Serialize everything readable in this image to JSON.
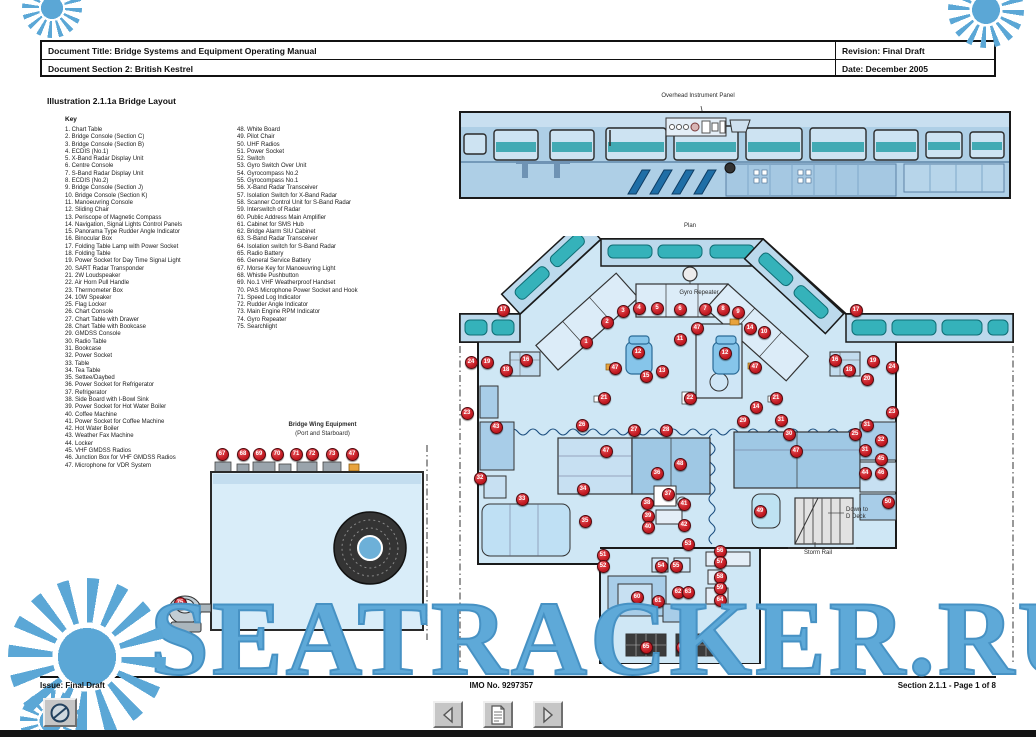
{
  "header": {
    "title": "Document Title: Bridge Systems and Equipment Operating Manual",
    "section": "Document Section 2: British Kestrel",
    "revision": "Revision: Final Draft",
    "date": "Date: December 2005"
  },
  "illustration_title": "Illustration 2.1.1a Bridge Layout",
  "key": {
    "heading": "Key",
    "col1": [
      "1. Chart Table",
      "2. Bridge Console (Section C)",
      "3. Bridge Console (Section B)",
      "4. ECDIS (No.1)",
      "5. X-Band Radar Display Unit",
      "6. Centre Console",
      "7. S-Band Radar Display Unit",
      "8. ECDIS (No.2)",
      "9. Bridge Console (Section J)",
      "10. Bridge Console (Section K)",
      "11. Manoeuvring Console",
      "12. Sliding Chair",
      "13. Periscope of Magnetic Compass",
      "14. Navigation, Signal Lights Control Panels",
      "15. Panorama Type Rudder Angle Indicator",
      "16. Binocular Box",
      "17. Folding Table Lamp with Power Socket",
      "18. Folding Table",
      "19. Power Socket for Day Time Signal Light",
      "20. SART Radar Transponder",
      "21. 2W Loudspeaker",
      "22. Air Horn Pull Handle",
      "23. Thermometer Box",
      "24. 10W Speaker",
      "25. Flag Locker",
      "26. Chart Console",
      "27. Chart Table with Drawer",
      "28. Chart Table with Bookcase",
      "29. GMDSS Console",
      "30. Radio Table",
      "31. Bookcase",
      "32. Power Socket",
      "33. Table",
      "34. Tea Table",
      "35. Settee/Daybed",
      "36. Power Socket for Refrigerator",
      "37. Refrigerator",
      "38. Side Board with I-Bowl Sink",
      "39. Power Socket for Hot Water Boiler",
      "40. Coffee Machine",
      "41. Power Socket for Coffee Machine",
      "42. Hot Water Boiler",
      "43. Weather Fax Machine",
      "44. Locker",
      "45. VHF GMDSS Radios",
      "46. Junction Box for VHF GMDSS Radios",
      "47. Microphone for VDR System"
    ],
    "col2": [
      "48. White Board",
      "49. Pilot Chair",
      "50. UHF Radios",
      "51. Power Socket",
      "52. Switch",
      "53. Gyro Switch Over Unit",
      "54. Gyrocompass No.2",
      "55. Gyrocompass No.1",
      "56. X-Band Radar Transceiver",
      "57. Isolation Switch for X-Band Radar",
      "58. Scanner Control Unit for S-Band Radar",
      "59. Interswitch of Radar",
      "60. Public Address Main Amplifier",
      "61. Cabinet for SMS Hub",
      "62. Bridge Alarm SIU Cabinet",
      "63. S-Band Radar Transceiver",
      "64. Isolation switch for S-Band Radar",
      "65. Radio Battery",
      "66. General Service Battery",
      "67. Morse Key for Manoeuvring Light",
      "68. Whistle Pushbutton",
      "69. No.1 VHF Weatherproof Handset",
      "70. PAS Microphone Power Socket and Hook",
      "71. Speed Log Indicator",
      "72. Rudder Angle Indicator",
      "73. Main Engine RPM Indicator",
      "74. Gyro Repeater",
      "75. Searchlight"
    ]
  },
  "diagram": {
    "labels": {
      "overhead": "Overhead Instrument Panel",
      "plan": "Plan",
      "gyro_repeater": "Gyro Repeater",
      "down_to": "Down to",
      "d_deck": "D Deck",
      "storm_rail": "Storm Rail",
      "wing_title": "Bridge Wing Equipment",
      "wing_sub": "(Port and Starboard)"
    },
    "plan_markers": [
      {
        "n": "1",
        "x": 128,
        "y": 106
      },
      {
        "n": "2",
        "x": 149,
        "y": 86
      },
      {
        "n": "3",
        "x": 165,
        "y": 75
      },
      {
        "n": "4",
        "x": 181,
        "y": 72
      },
      {
        "n": "5",
        "x": 199,
        "y": 72
      },
      {
        "n": "6",
        "x": 222,
        "y": 73
      },
      {
        "n": "7",
        "x": 247,
        "y": 73
      },
      {
        "n": "8",
        "x": 265,
        "y": 73
      },
      {
        "n": "9",
        "x": 280,
        "y": 76
      },
      {
        "n": "14",
        "x": 292,
        "y": 92
      },
      {
        "n": "10",
        "x": 306,
        "y": 96
      },
      {
        "n": "47",
        "x": 239,
        "y": 92
      },
      {
        "n": "11",
        "x": 222,
        "y": 103
      },
      {
        "n": "12",
        "x": 180,
        "y": 116
      },
      {
        "n": "12",
        "x": 267,
        "y": 117
      },
      {
        "n": "13",
        "x": 204,
        "y": 135
      },
      {
        "n": "15",
        "x": 188,
        "y": 140
      },
      {
        "n": "47",
        "x": 157,
        "y": 132
      },
      {
        "n": "47",
        "x": 297,
        "y": 131
      },
      {
        "n": "17",
        "x": 45,
        "y": 74
      },
      {
        "n": "16",
        "x": 68,
        "y": 124
      },
      {
        "n": "18",
        "x": 48,
        "y": 134
      },
      {
        "n": "19",
        "x": 29,
        "y": 126
      },
      {
        "n": "24",
        "x": 13,
        "y": 126
      },
      {
        "n": "17",
        "x": 398,
        "y": 74
      },
      {
        "n": "16",
        "x": 377,
        "y": 124
      },
      {
        "n": "18",
        "x": 391,
        "y": 134
      },
      {
        "n": "19",
        "x": 415,
        "y": 125
      },
      {
        "n": "20",
        "x": 409,
        "y": 143
      },
      {
        "n": "24",
        "x": 434,
        "y": 131
      },
      {
        "n": "23",
        "x": 9,
        "y": 177
      },
      {
        "n": "23",
        "x": 434,
        "y": 176
      },
      {
        "n": "21",
        "x": 146,
        "y": 162
      },
      {
        "n": "22",
        "x": 232,
        "y": 162
      },
      {
        "n": "21",
        "x": 318,
        "y": 162
      },
      {
        "n": "14",
        "x": 298,
        "y": 171
      },
      {
        "n": "43",
        "x": 38,
        "y": 191
      },
      {
        "n": "26",
        "x": 124,
        "y": 189
      },
      {
        "n": "27",
        "x": 176,
        "y": 194
      },
      {
        "n": "28",
        "x": 208,
        "y": 194
      },
      {
        "n": "29",
        "x": 285,
        "y": 185
      },
      {
        "n": "31",
        "x": 323,
        "y": 184
      },
      {
        "n": "30",
        "x": 331,
        "y": 198
      },
      {
        "n": "25",
        "x": 397,
        "y": 198
      },
      {
        "n": "31",
        "x": 409,
        "y": 189
      },
      {
        "n": "32",
        "x": 423,
        "y": 204
      },
      {
        "n": "31",
        "x": 407,
        "y": 214
      },
      {
        "n": "45",
        "x": 423,
        "y": 223
      },
      {
        "n": "44",
        "x": 407,
        "y": 237
      },
      {
        "n": "46",
        "x": 423,
        "y": 237
      },
      {
        "n": "47",
        "x": 148,
        "y": 215
      },
      {
        "n": "47",
        "x": 338,
        "y": 215
      },
      {
        "n": "48",
        "x": 222,
        "y": 228
      },
      {
        "n": "36",
        "x": 199,
        "y": 237
      },
      {
        "n": "32",
        "x": 22,
        "y": 242
      },
      {
        "n": "33",
        "x": 64,
        "y": 263
      },
      {
        "n": "34",
        "x": 125,
        "y": 253
      },
      {
        "n": "35",
        "x": 127,
        "y": 285
      },
      {
        "n": "37",
        "x": 210,
        "y": 258
      },
      {
        "n": "38",
        "x": 189,
        "y": 267
      },
      {
        "n": "39",
        "x": 190,
        "y": 280
      },
      {
        "n": "40",
        "x": 190,
        "y": 291
      },
      {
        "n": "41",
        "x": 226,
        "y": 268
      },
      {
        "n": "42",
        "x": 226,
        "y": 289
      },
      {
        "n": "49",
        "x": 302,
        "y": 275
      },
      {
        "n": "50",
        "x": 430,
        "y": 266
      },
      {
        "n": "53",
        "x": 230,
        "y": 308
      },
      {
        "n": "51",
        "x": 145,
        "y": 319
      },
      {
        "n": "52",
        "x": 145,
        "y": 330
      },
      {
        "n": "54",
        "x": 203,
        "y": 330
      },
      {
        "n": "55",
        "x": 218,
        "y": 330
      },
      {
        "n": "56",
        "x": 262,
        "y": 315
      },
      {
        "n": "57",
        "x": 262,
        "y": 326
      },
      {
        "n": "58",
        "x": 262,
        "y": 341
      },
      {
        "n": "59",
        "x": 262,
        "y": 352
      },
      {
        "n": "60",
        "x": 179,
        "y": 361
      },
      {
        "n": "61",
        "x": 200,
        "y": 365
      },
      {
        "n": "62",
        "x": 220,
        "y": 356
      },
      {
        "n": "63",
        "x": 230,
        "y": 356
      },
      {
        "n": "64",
        "x": 262,
        "y": 364
      },
      {
        "n": "65",
        "x": 188,
        "y": 411
      },
      {
        "n": "66",
        "x": 224,
        "y": 411
      }
    ],
    "wing_markers": [
      {
        "n": "67",
        "x": 57,
        "y": 14
      },
      {
        "n": "68",
        "x": 78,
        "y": 14
      },
      {
        "n": "69",
        "x": 94,
        "y": 14
      },
      {
        "n": "70",
        "x": 112,
        "y": 14
      },
      {
        "n": "71",
        "x": 131,
        "y": 14
      },
      {
        "n": "72",
        "x": 147,
        "y": 14
      },
      {
        "n": "73",
        "x": 167,
        "y": 14
      },
      {
        "n": "47",
        "x": 187,
        "y": 14
      },
      {
        "n": "75",
        "x": 15,
        "y": 163
      }
    ]
  },
  "footer": {
    "issue": "Issue: Final Draft",
    "imo": "IMO No. 9297357",
    "section_page": "Section 2.1.1  -  Page 1 of 8"
  },
  "watermark": {
    "text": "SEATRACKER.RU",
    "color": "#5EA9D8"
  },
  "icons": {
    "prev": "left-arrow-icon",
    "pages": "document-icon",
    "next": "right-arrow-icon",
    "corner": "circle-logo-icon",
    "watermark": "sun-icon"
  },
  "colors": {
    "marker_red": "#C8232C",
    "window_teal": "#35B2BA",
    "hull_light_blue": "#CFE7F5",
    "hull_mid_blue": "#A9CFE8",
    "watermark_blue": "#5EA9D8",
    "text_black": "#111111"
  }
}
